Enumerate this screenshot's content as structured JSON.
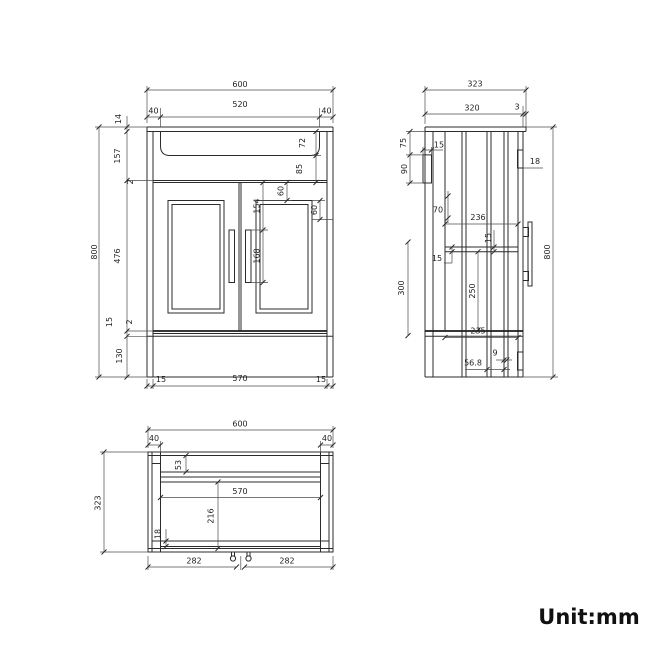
{
  "unit_label": "Unit:mm",
  "colors": {
    "background": "#ffffff",
    "line": "#2b2b2b",
    "dimension_line": "#4d4d4d",
    "text": "#1f1f1f"
  },
  "views": {
    "front": {
      "overall_width": "600",
      "basin_offset_left": "40",
      "basin_width": "520",
      "basin_offset_right": "40",
      "basin_depth": "72",
      "basin_to_door": "85",
      "panel_top_inset": "60",
      "handle_top_offset": "154",
      "handle_length": "168",
      "panel_side_inset": "60",
      "counter_thickness": "14",
      "top_section_height": "157",
      "gap_top": "2",
      "door_height": "476",
      "bottom_rail": "15",
      "gap_bottom": "2",
      "plinth_height": "130",
      "overall_height": "800",
      "bottom_inset_left": "15",
      "bottom_inner_width": "570",
      "bottom_inset_right": "15"
    },
    "side": {
      "overall_depth": "323",
      "body_depth": "320",
      "front_overhang": "3",
      "bracket_offset": "75",
      "bracket_inset": "15",
      "bracket_height": "90",
      "hinge_height": "18",
      "rail_offset": "70",
      "shelf_depth": "236",
      "rail_thickness_a": "15",
      "rail_thickness_b": "15",
      "lower_section": "300",
      "door_inner": "250",
      "overall_height": "800",
      "bottom_depth": "235",
      "leg_step": "9",
      "leg_offset": "56.8"
    },
    "plan": {
      "overall_width": "600",
      "panel_left": "40",
      "panel_right": "40",
      "back_rail": "53",
      "inner_width": "570",
      "inner_depth": "216",
      "front_rail": "18",
      "handle_left_span": "282",
      "handle_right_span": "282",
      "overall_depth": "323"
    }
  }
}
